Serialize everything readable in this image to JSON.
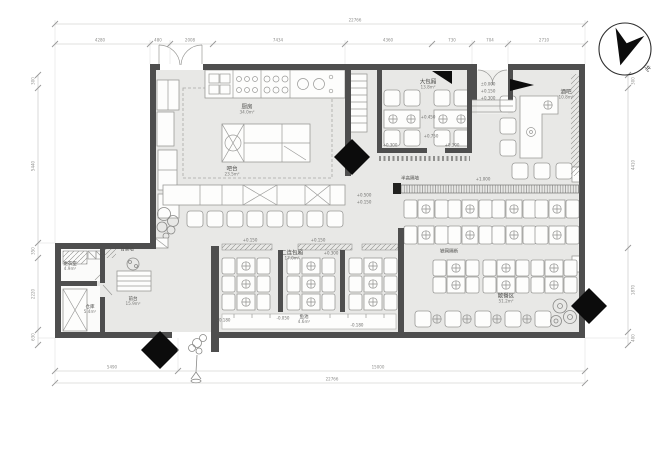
{
  "plan": {
    "compass_label": "北",
    "rooms": {
      "kitchen": {
        "name": "厨房",
        "area": "34.0m²"
      },
      "bar_counter": {
        "name": "吧台",
        "area": "23.5m²"
      },
      "large_box": {
        "name": "大包厢",
        "area": "13.8m²"
      },
      "pub": {
        "name": "酒吧",
        "area": "10.8m²"
      },
      "double_box": {
        "name": "二连包厢",
        "area": "17.0m²"
      },
      "open_dining": {
        "name": "散餐区",
        "area": "51.2m²"
      },
      "fish_pond": {
        "name": "鱼池",
        "area": "4.6m²"
      },
      "changing_room": {
        "name": "更衣室",
        "area": "4.9m²"
      },
      "storage": {
        "name": "仓库",
        "area": "5.4m²"
      },
      "reception": {
        "name": "前台",
        "area": "15.9m²"
      },
      "feature_wall": {
        "name": "背景墙"
      },
      "half_wall": {
        "name": "半高隔墙"
      },
      "mesh_partition": {
        "name": "铁网隔断"
      }
    },
    "levels": {
      "zero": "±0.000",
      "p150": "+0.150",
      "p300": "+0.300",
      "p450": "+0.450",
      "p500": "+0.500",
      "p750": "+0.750",
      "p1000": "+1.000",
      "m050": "-0.050",
      "m180": "-0.180"
    },
    "dims": {
      "top_total": "22766",
      "top": [
        "4280",
        "480",
        "2008",
        "7434",
        "4360",
        "730",
        "704",
        "2710"
      ],
      "bottom": [
        "5490",
        "15000"
      ],
      "bottom_total": "22766",
      "left": [
        "300",
        "5440",
        "350",
        "2220",
        "630"
      ],
      "right": [
        "300",
        "4410",
        "1870",
        "400"
      ]
    }
  }
}
